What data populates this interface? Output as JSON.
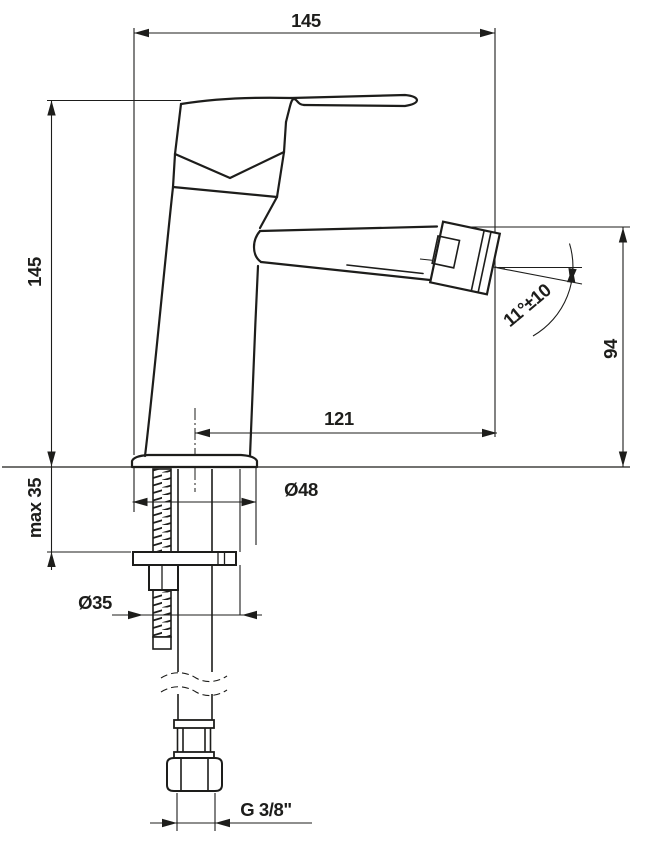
{
  "drawing": {
    "type": "technical-dimension-drawing",
    "subject": "single-lever bidet mixer, side view with installation parts",
    "colors": {
      "line": "#1d1d1b",
      "background": "#ffffff"
    },
    "labels": {
      "overall_length": "145",
      "body_height": "145",
      "max_deck_thickness": "max 35",
      "spout_reach": "121",
      "spout_outlet_height": "94",
      "spout_angle": "11°±10",
      "base_diameter": "Ø48",
      "hole_diameter": "Ø35",
      "connection_thread": "G 3/8\""
    }
  }
}
